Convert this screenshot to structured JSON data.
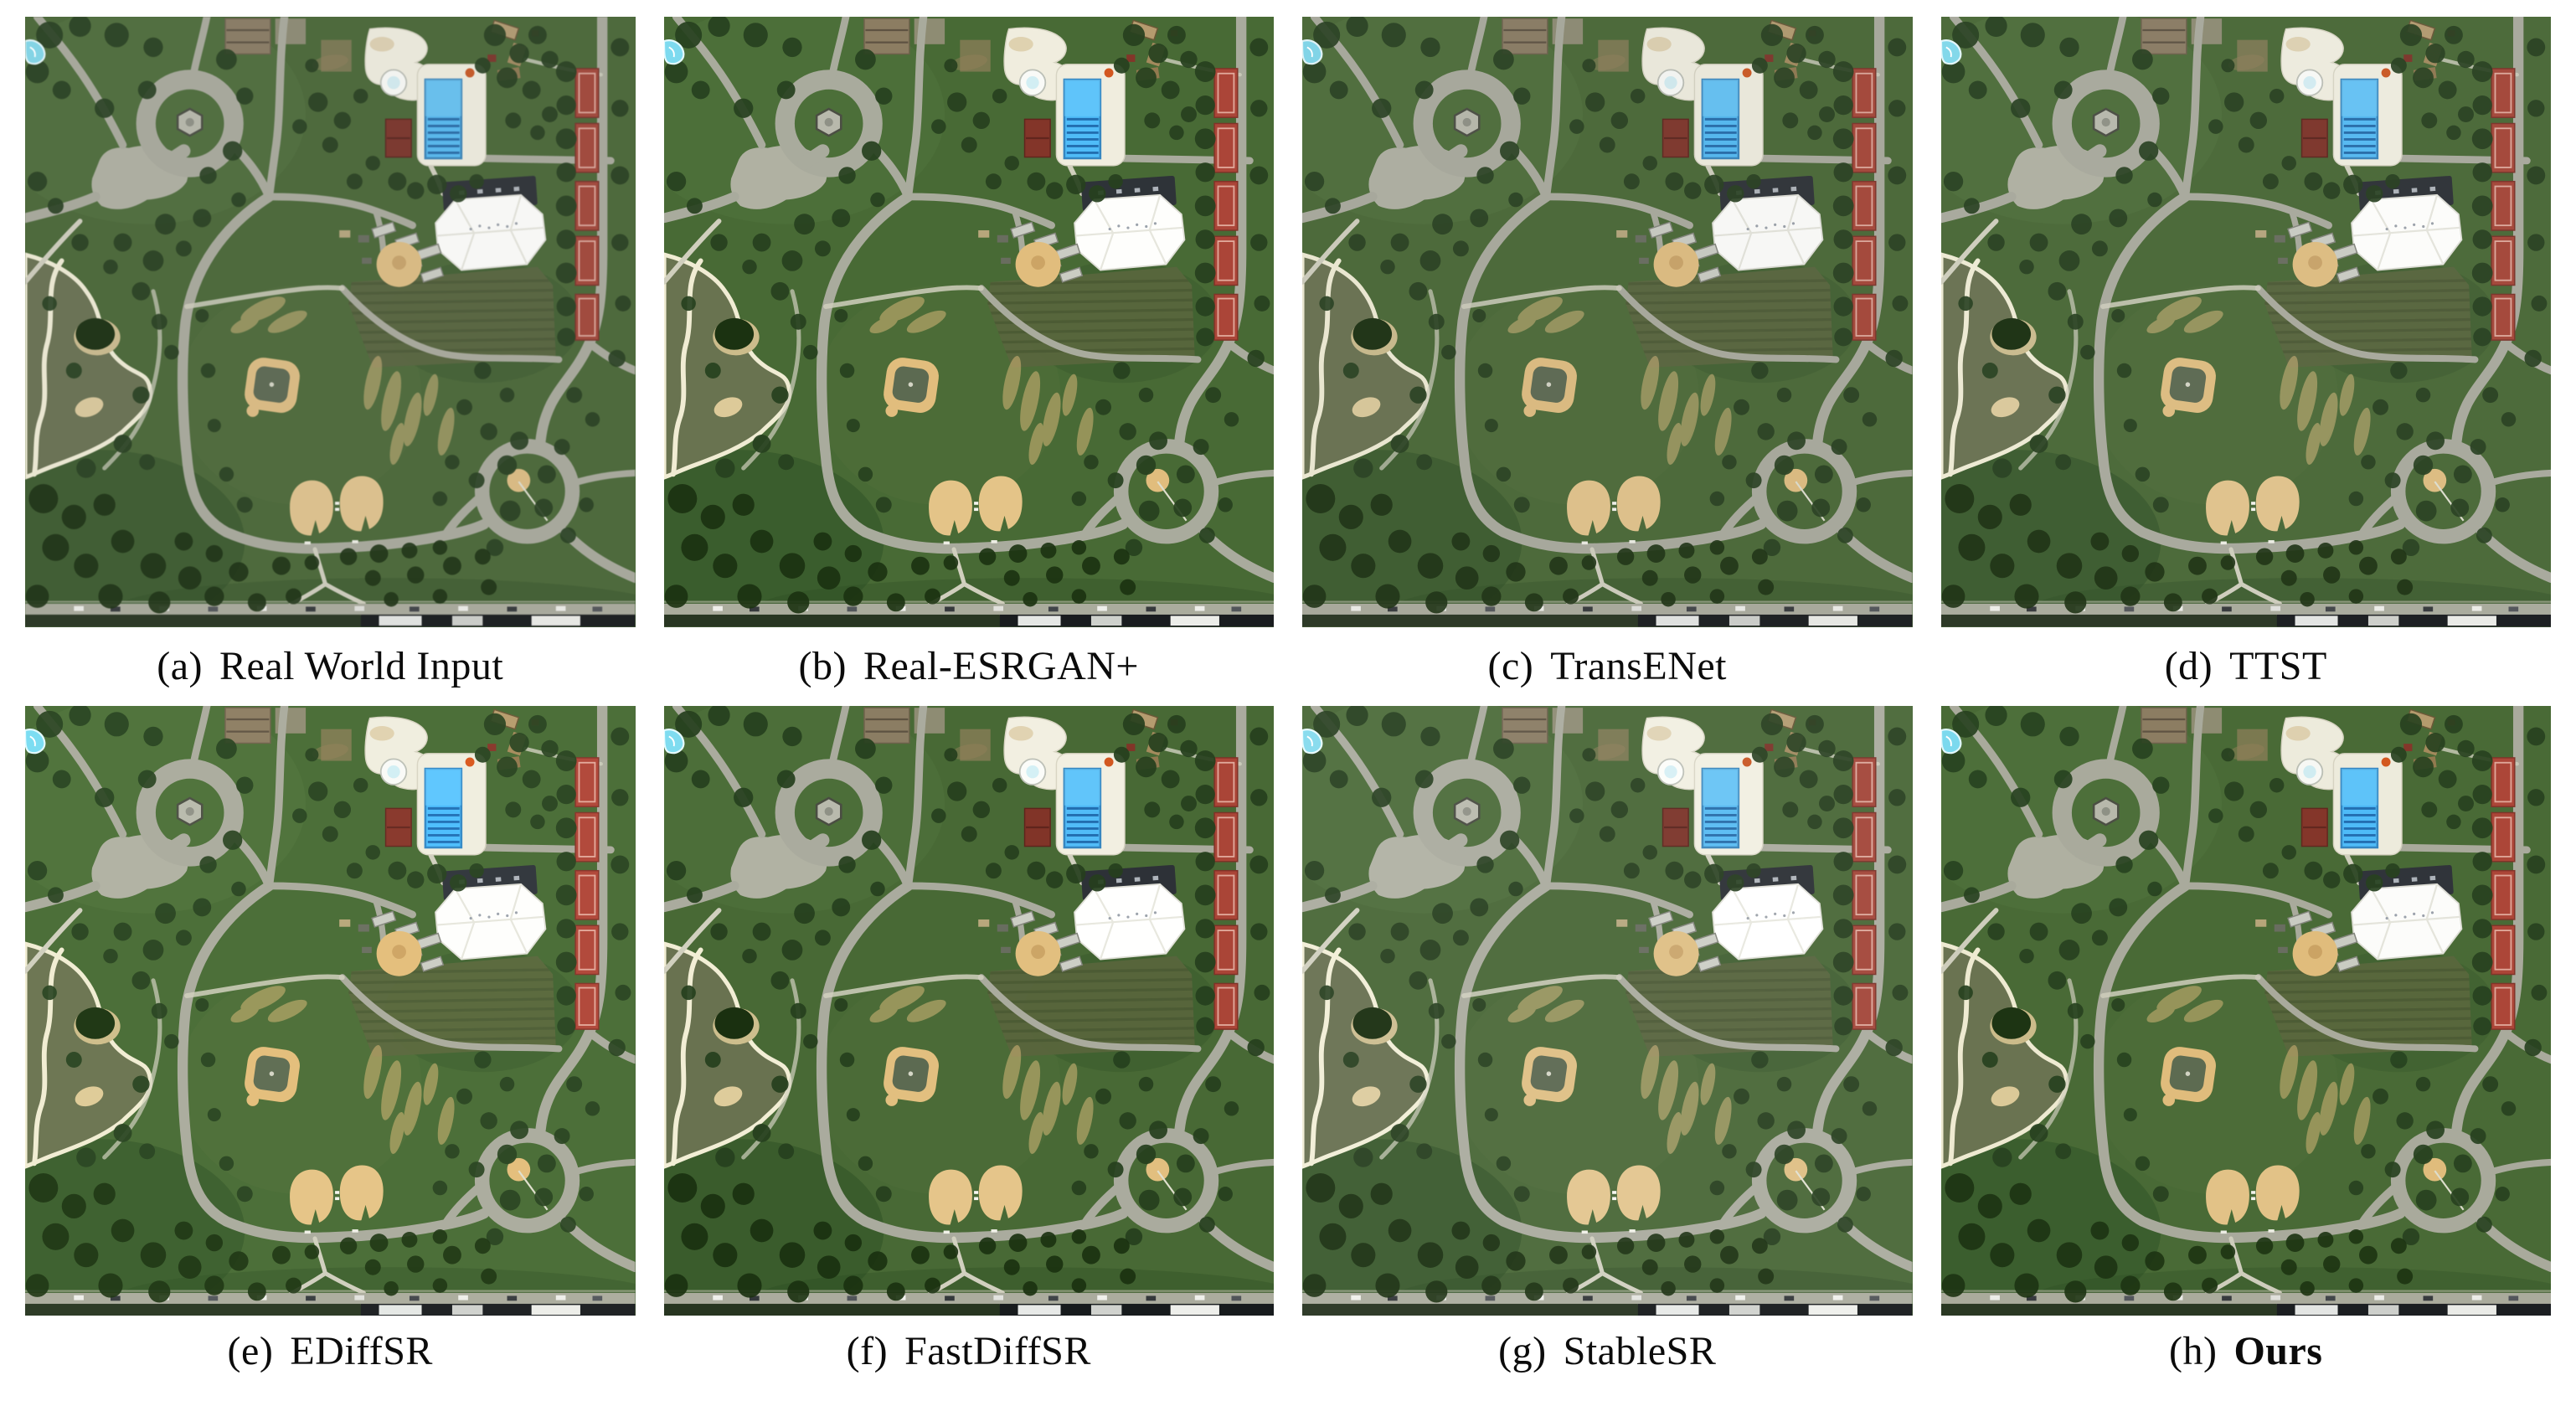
{
  "figure": {
    "title": "Qualitative comparison of super-resolution methods on a real-world aerial park scene",
    "panels": [
      {
        "id": "a",
        "label": "(a)",
        "method": "Real World Input",
        "bold": false
      },
      {
        "id": "b",
        "label": "(b)",
        "method": "Real-ESRGAN+",
        "bold": false
      },
      {
        "id": "c",
        "label": "(c)",
        "method": "TransENet",
        "bold": false
      },
      {
        "id": "d",
        "label": "(d)",
        "method": "TTST",
        "bold": false
      },
      {
        "id": "e",
        "label": "(e)",
        "method": "EDiffSR",
        "bold": false
      },
      {
        "id": "f",
        "label": "(f)",
        "method": "FastDiffSR",
        "bold": false
      },
      {
        "id": "g",
        "label": "(g)",
        "method": "StableSR",
        "bold": false
      },
      {
        "id": "h",
        "label": "(h)",
        "method": "Ours",
        "bold": true
      }
    ],
    "scene_landmarks": [
      "park lawn",
      "swimming pool",
      "splash pad",
      "round tank",
      "pool house",
      "white pavilion arena",
      "bleachers",
      "softball diamond",
      "baseball diamond",
      "two sand fields",
      "pond with island",
      "circular plaza with gazebo",
      "traffic circle",
      "tennis courts",
      "parking lot",
      "street with buildings",
      "trees"
    ],
    "scene_colors": {
      "grass": "#4d6a3c",
      "grass_light": "#5a7747",
      "grass_dark": "#33512c",
      "road": "#a7a89c",
      "path": "#cbcabb",
      "plaza": "#adaea1",
      "pond": "#6b7355",
      "shore": "#e9e6d0",
      "pool": "#58b7ec",
      "pool_lane": "#2c6ea8",
      "deck": "#e9e7da",
      "sand": "#d9ba82",
      "sand_light": "#dcc08c",
      "roof_red": "#7e3a30",
      "court_red": "#a34a3e",
      "arena_white": "#f7f7f5",
      "arena_roof": "#33373c",
      "tree": "#2d4426",
      "tree_dark": "#223619",
      "street": "#a8a99c",
      "street_dark": "#1f2224",
      "mowed": "#5c6744",
      "parking": "#8a7d66",
      "infield": "#5f6b55",
      "water_cyan": "#82d4e6"
    }
  }
}
